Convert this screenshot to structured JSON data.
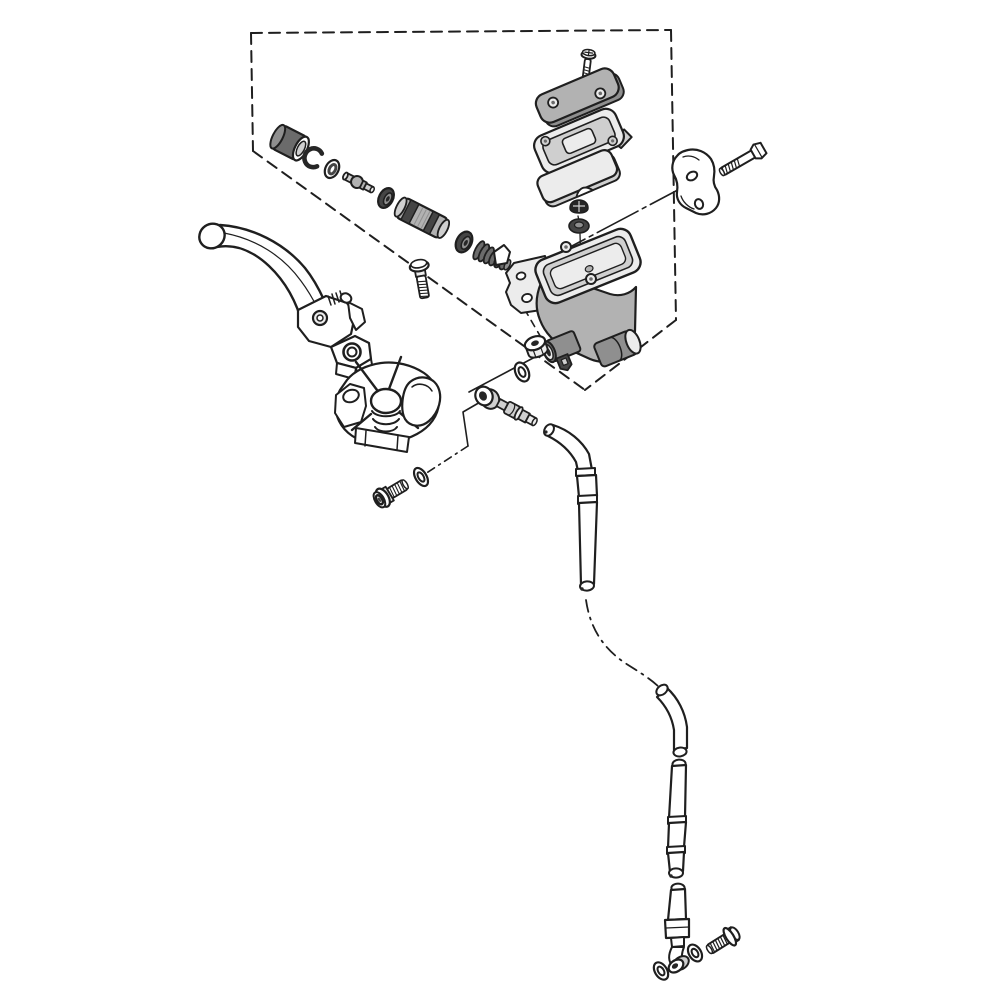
{
  "colors": {
    "paper": "#ffffff",
    "ink": "#1f1f1f",
    "g1": "#ececec",
    "g2": "#cfcfcf",
    "g3": "#b2b2b2",
    "g4": "#8f8f8f",
    "g5": "#6b6b6b",
    "g6": "#454545",
    "bk": "#262626"
  },
  "diagram": {
    "type": "exploded-parts-line-drawing",
    "subject": "front brake master cylinder assembly",
    "text_labels": [],
    "parts": [
      {
        "id": "boundary-box",
        "label": "dashed exploded-view boundary"
      },
      {
        "id": "reservoir-screw",
        "label": "reservoir cap screw"
      },
      {
        "id": "reservoir-cap",
        "label": "reservoir cap"
      },
      {
        "id": "float-plate",
        "label": "diaphragm plate"
      },
      {
        "id": "diaphragm",
        "label": "reservoir diaphragm"
      },
      {
        "id": "piston-boot",
        "label": "piston dust boot"
      },
      {
        "id": "circlip",
        "label": "circlip"
      },
      {
        "id": "spacer-washer",
        "label": "washer"
      },
      {
        "id": "push-rod",
        "label": "push rod"
      },
      {
        "id": "primary-cup",
        "label": "primary cup seal"
      },
      {
        "id": "piston",
        "label": "master cylinder piston"
      },
      {
        "id": "secondary-cup",
        "label": "secondary cup seal"
      },
      {
        "id": "return-spring",
        "label": "piston return spring"
      },
      {
        "id": "lever-pivot-bolt",
        "label": "lever pivot bolt"
      },
      {
        "id": "brake-lever",
        "label": "brake lever"
      },
      {
        "id": "lever-holder-boot",
        "label": "lever holder with boot"
      },
      {
        "id": "clamp-bracket",
        "label": "handlebar clamp bracket"
      },
      {
        "id": "clamp-bolt",
        "label": "clamp bolt"
      },
      {
        "id": "master-cylinder-body",
        "label": "master cylinder body"
      },
      {
        "id": "reservoir-plug",
        "label": "reservoir plug cap"
      },
      {
        "id": "grommet",
        "label": "grommet"
      },
      {
        "id": "joint-nut",
        "label": "flanged joint nut"
      },
      {
        "id": "sealing-washer",
        "label": "sealing washer"
      },
      {
        "id": "hose-joint",
        "label": "hose joint fitting"
      },
      {
        "id": "hose-upper",
        "label": "brake hose upper section"
      },
      {
        "id": "hose-hidden-route",
        "label": "hidden hose routing"
      },
      {
        "id": "hose-middle",
        "label": "brake hose middle section"
      },
      {
        "id": "hose-lower",
        "label": "brake hose lower section"
      },
      {
        "id": "hose-end-eye",
        "label": "hose end banjo eye"
      },
      {
        "id": "banjo-washer-inner",
        "label": "banjo sealing washer"
      },
      {
        "id": "banjo-washer-outer",
        "label": "banjo sealing washer"
      },
      {
        "id": "banjo-bolt",
        "label": "banjo bolt"
      },
      {
        "id": "mount-bolt",
        "label": "mounting socket bolt"
      },
      {
        "id": "mount-washer",
        "label": "mounting washer"
      },
      {
        "id": "leader-lines",
        "label": "assembly leader lines"
      }
    ]
  }
}
